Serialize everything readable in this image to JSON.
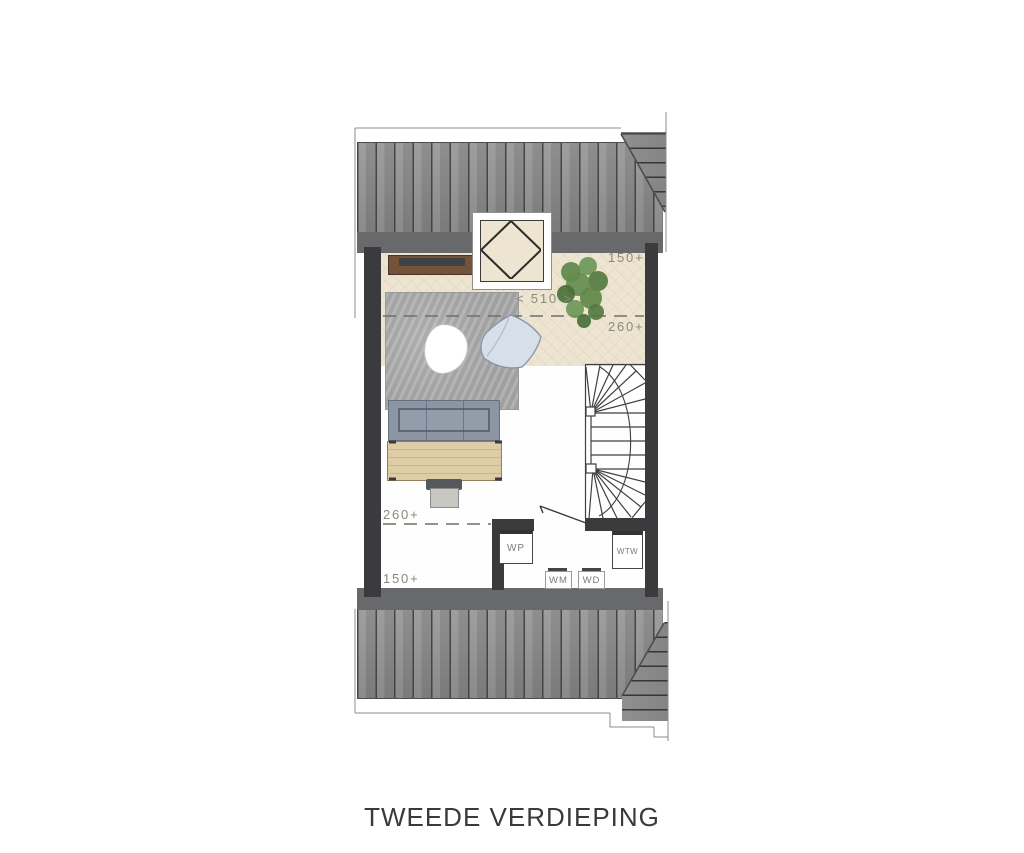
{
  "plan": {
    "floor_name": "TWEEDE VERDIEPING",
    "dimensions": {
      "top_height_label": "150+",
      "width_label": "< 510 >",
      "upper_ridge_label": "260+",
      "lower_ridge_label": "260+",
      "bottom_height_label": "150+"
    },
    "equipment": {
      "heat_pump": "WP",
      "heat_recovery": "WTW",
      "washing_machine": "WM",
      "dryer": "WD"
    },
    "colors": {
      "roof_stripe_base": "#8e8e8e",
      "roof_stripe_line": "#4e4e4e",
      "eave_band": "#68696b",
      "wall": "#3b3b3d",
      "floor_beige": "#ede5d1",
      "floor_white": "#fefefe",
      "rug_gray": "#a9a9a9",
      "sofa_gray_blue": "#8c95a4",
      "table_wood": "#decca7",
      "sideboard_wood": "#74533b",
      "pillow_blue": "#d6dfea",
      "plant_green": "#5e8748",
      "dimension_text": "#8b887b",
      "title_text": "#3a3a3a"
    }
  }
}
